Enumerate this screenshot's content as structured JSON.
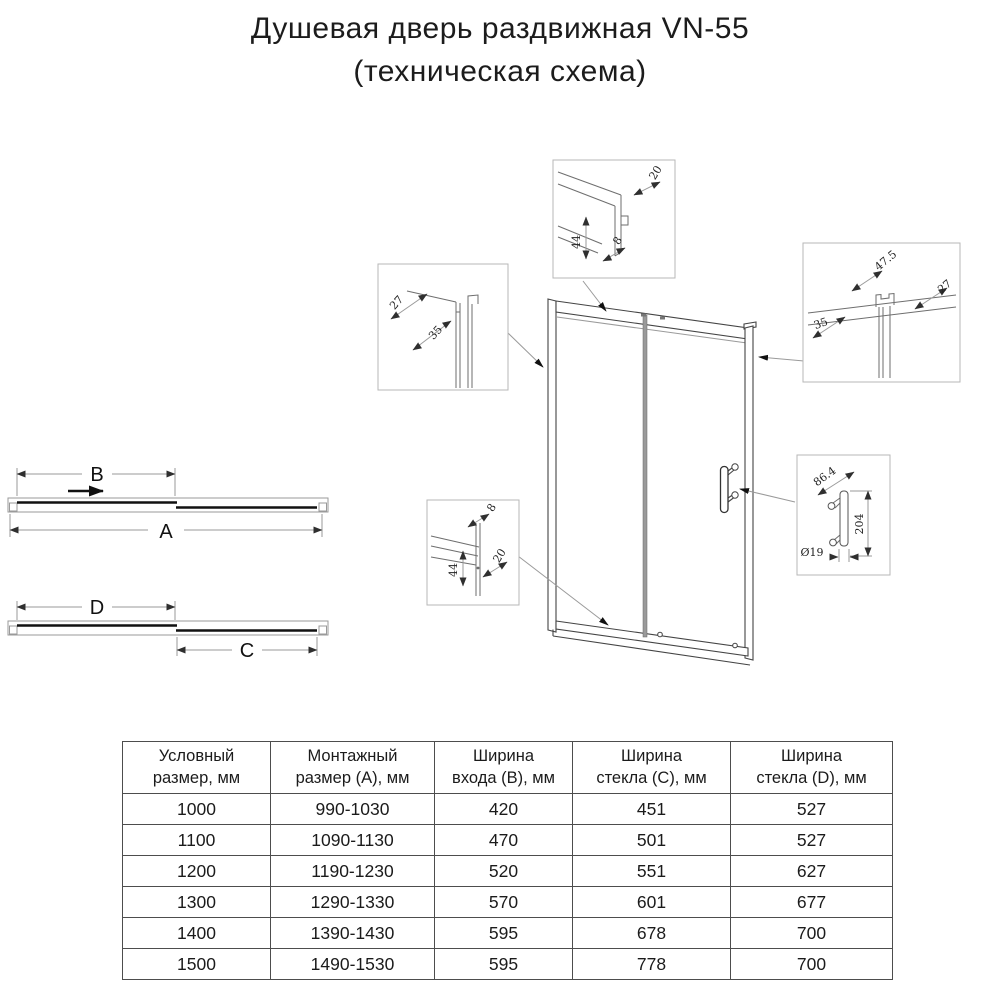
{
  "title": {
    "line1": "Душевая дверь раздвижная VN-55",
    "line2": "(техническая схема)"
  },
  "plan": {
    "open": {
      "total_width_label": "A",
      "entry_width_label": "B"
    },
    "closed": {
      "fixed_glass_label": "C",
      "door_glass_label": "D"
    }
  },
  "callouts": {
    "top_joint": {
      "d1": "20",
      "d2": "44",
      "d3": "8"
    },
    "wall_profile": {
      "d1": "27",
      "d2": "35"
    },
    "top_glass_joint": {
      "d1": "47.5",
      "d2": "27",
      "d3": "35"
    },
    "bottom_joint": {
      "d1": "8",
      "d2": "20",
      "d3": "44"
    },
    "handle": {
      "d1": "86.4",
      "d2": "204",
      "d3": "Ø19"
    }
  },
  "table": {
    "headers": [
      "Условный\nразмер, мм",
      "Монтажный\nразмер (A), мм",
      "Ширина\nвхода (B), мм",
      "Ширина\nстекла (C), мм",
      "Ширина\nстекла (D), мм"
    ],
    "rows": [
      [
        "1000",
        "990-1030",
        "420",
        "451",
        "527"
      ],
      [
        "1100",
        "1090-1130",
        "470",
        "501",
        "527"
      ],
      [
        "1200",
        "1190-1230",
        "520",
        "551",
        "627"
      ],
      [
        "1300",
        "1290-1330",
        "570",
        "601",
        "677"
      ],
      [
        "1400",
        "1390-1430",
        "595",
        "678",
        "700"
      ],
      [
        "1500",
        "1490-1530",
        "595",
        "778",
        "700"
      ]
    ]
  },
  "colors": {
    "line_main": "#444444",
    "line_thin": "#9a9a9a",
    "glass_bar": "#111111",
    "text": "#1b1b1b"
  }
}
